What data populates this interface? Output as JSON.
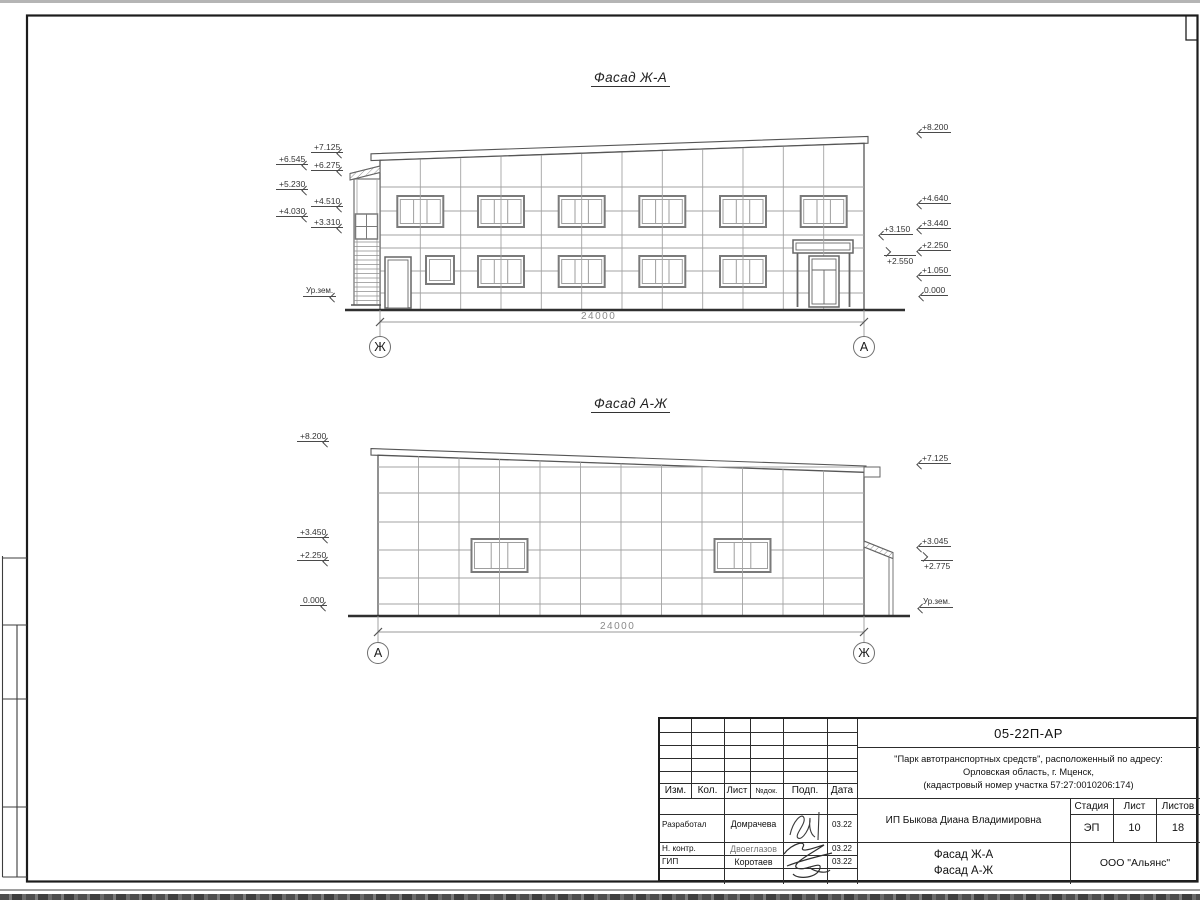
{
  "facade1": {
    "title": "Фасад Ж-А",
    "span_label": "24000",
    "axis_left": "Ж",
    "axis_right": "А",
    "ground_label": "Ур.зем.",
    "marks_left": [
      "+7.125",
      "+6.545",
      "+6.275",
      "+5.230",
      "+4.510",
      "+4.030",
      "+3.310"
    ],
    "marks_right": [
      "+8.200",
      "+4.640",
      "+3.440",
      "+2.250",
      "+1.050",
      "0.000"
    ],
    "marks_entrance": [
      "+3.150",
      "+2.550"
    ]
  },
  "facade2": {
    "title": "Фасад А-Ж",
    "span_label": "24000",
    "axis_left": "А",
    "axis_right": "Ж",
    "ground_label": "Ур.зем.",
    "marks_left": [
      "+8.200",
      "+3.450",
      "+2.250",
      "0.000"
    ],
    "marks_right": [
      "+7.125",
      "+3.045",
      "+2.775"
    ]
  },
  "titleblock": {
    "code": "05-22П-АР",
    "project": [
      "\"Парк автотранспортных средств\",  расположенный по адресу:",
      "Орловская область, г. Мценск,",
      "(кадастровый номер участка 57:27:0010206:174)"
    ],
    "client": "ИП Быкова Диана Владимировна",
    "drawing_title": [
      "Фасад Ж-А",
      "Фасад А-Ж"
    ],
    "company": "ООО \"Альянс\"",
    "columns": {
      "izm": "Изм.",
      "kol": "Кол.",
      "list": "Лист",
      "ndok": "№док.",
      "podp": "Подп.",
      "data": "Дата"
    },
    "stage_header": {
      "stadia": "Стадия",
      "list": "Лист",
      "listov": "Листов"
    },
    "stage_values": {
      "stadia": "ЭП",
      "list": "10",
      "listov": "18"
    },
    "staff": [
      {
        "role": "Разработал",
        "name": "Домрачева",
        "date": "03.22"
      },
      {
        "role": "Н. контр.",
        "name": "Двоеглазов",
        "date": "03.22"
      },
      {
        "role": "ГИП",
        "name": "Коротаев",
        "date": "03.22"
      }
    ]
  }
}
